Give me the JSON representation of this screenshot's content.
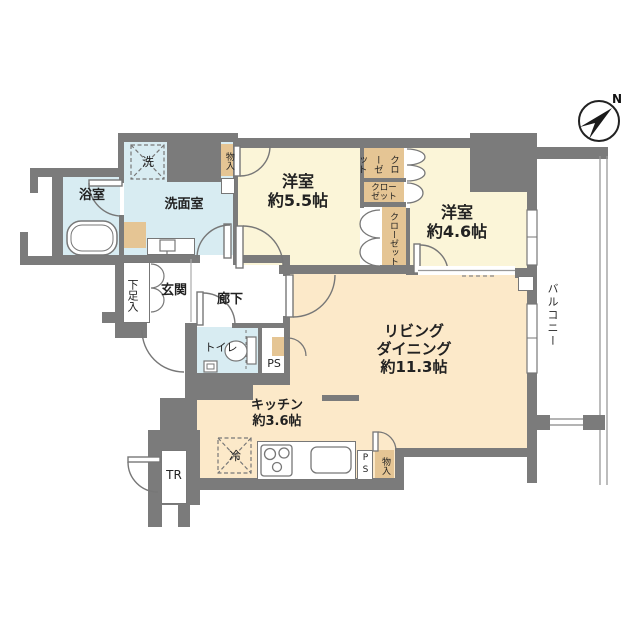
{
  "floorplan": {
    "compass": {
      "label": "N"
    },
    "rooms": {
      "bedroom1": {
        "name": "洋室",
        "area": "約5.5帖"
      },
      "bedroom2": {
        "name": "洋室",
        "area": "約4.6帖"
      },
      "living": {
        "line1": "リビング",
        "line2": "ダイニング",
        "area": "約11.3帖"
      },
      "kitchen": {
        "name": "キッチン",
        "area": "約3.6帖"
      },
      "bathroom": {
        "name": "浴室"
      },
      "washroom": {
        "name": "洗面室"
      },
      "toilet": {
        "name": "トイレ"
      },
      "entrance": {
        "name": "玄関"
      },
      "hallway": {
        "name": "廊下"
      },
      "balcony": {
        "name": "バルコニー"
      }
    },
    "fixtures": {
      "washer": "洗",
      "fridge": "冷",
      "shoe_cabinet": "下足入",
      "storage_top": "物入",
      "storage_bottom": "物入",
      "closet_right_top": "クローゼット",
      "closet_right_mid": "クローゼット",
      "closet_left": "クローゼット",
      "pipe_space_mid": "PS",
      "pipe_space_bottom": "PS",
      "trunk_room": "TR"
    },
    "colors": {
      "wall": "#7b7b7b",
      "bedroom_fill": "#fbf5d8",
      "living_fill": "#fce9c9",
      "wet_area_fill": "#d8ecf2",
      "closet_fill": "#e5c594",
      "line": "#777777"
    }
  }
}
